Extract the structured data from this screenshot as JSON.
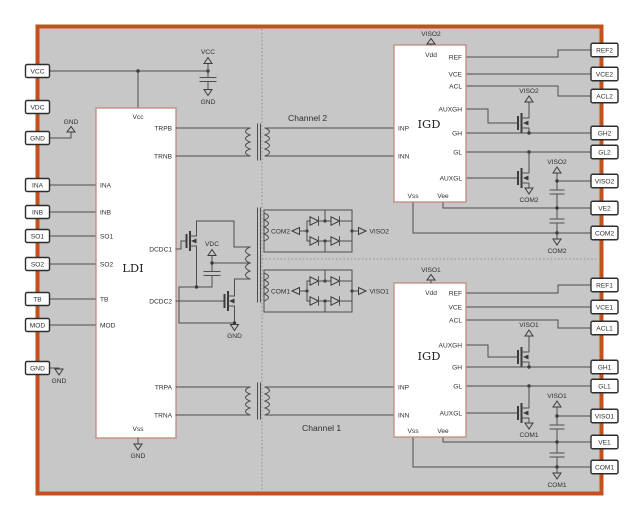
{
  "colors": {
    "frame": "#c2511b",
    "canvas": "#c7c7c7",
    "block_border": "#bf8374",
    "wire": "#4d4d4d",
    "pin_border": "#2d2d2d",
    "text": "#2e2e2e"
  },
  "channels": {
    "ch2": "Channel 2",
    "ch1": "Channel 1"
  },
  "nets": {
    "vcc": "VCC",
    "gnd": "GND",
    "vdc": "VDC",
    "viso2": "VISO2",
    "viso1": "VISO1",
    "com2": "COM2",
    "com1": "COM1"
  },
  "left_pins": [
    "VCC",
    "VDC",
    "GND",
    "INA",
    "INB",
    "SO1",
    "SO2",
    "TB",
    "MOD",
    "GND"
  ],
  "right_pins": [
    "REF2",
    "VCE2",
    "ACL2",
    "GH2",
    "GL2",
    "VISO2",
    "VE2",
    "COM2",
    "REF1",
    "VCE1",
    "ACL1",
    "GH1",
    "GL1",
    "VISO1",
    "VE1",
    "COM1"
  ],
  "ldi": {
    "title": "LDI",
    "top_pin": "Vcc",
    "bottom_pin": "Vss",
    "left_pins": [
      "INA",
      "INB",
      "SO1",
      "SO2",
      "TB",
      "MOD"
    ],
    "right_pins": [
      "TRPB",
      "TRNB",
      "DCDC1",
      "DCDC2",
      "TRPA",
      "TRNA"
    ]
  },
  "igd2": {
    "title": "IGD",
    "top_pin": "Vdd",
    "bottom_pins": [
      "Vss",
      "Vee"
    ],
    "left_pins": [
      "INP",
      "INN"
    ],
    "right_pins": [
      "REF",
      "VCE",
      "ACL",
      "AUXGH",
      "GH",
      "GL",
      "AUXGL"
    ]
  },
  "igd1": {
    "title": "IGD",
    "top_pin": "Vdd",
    "bottom_pins": [
      "Vss",
      "Vee"
    ],
    "left_pins": [
      "INP",
      "INN"
    ],
    "right_pins": [
      "REF",
      "VCE",
      "ACL",
      "AUXGH",
      "GH",
      "GL",
      "AUXGL"
    ]
  }
}
